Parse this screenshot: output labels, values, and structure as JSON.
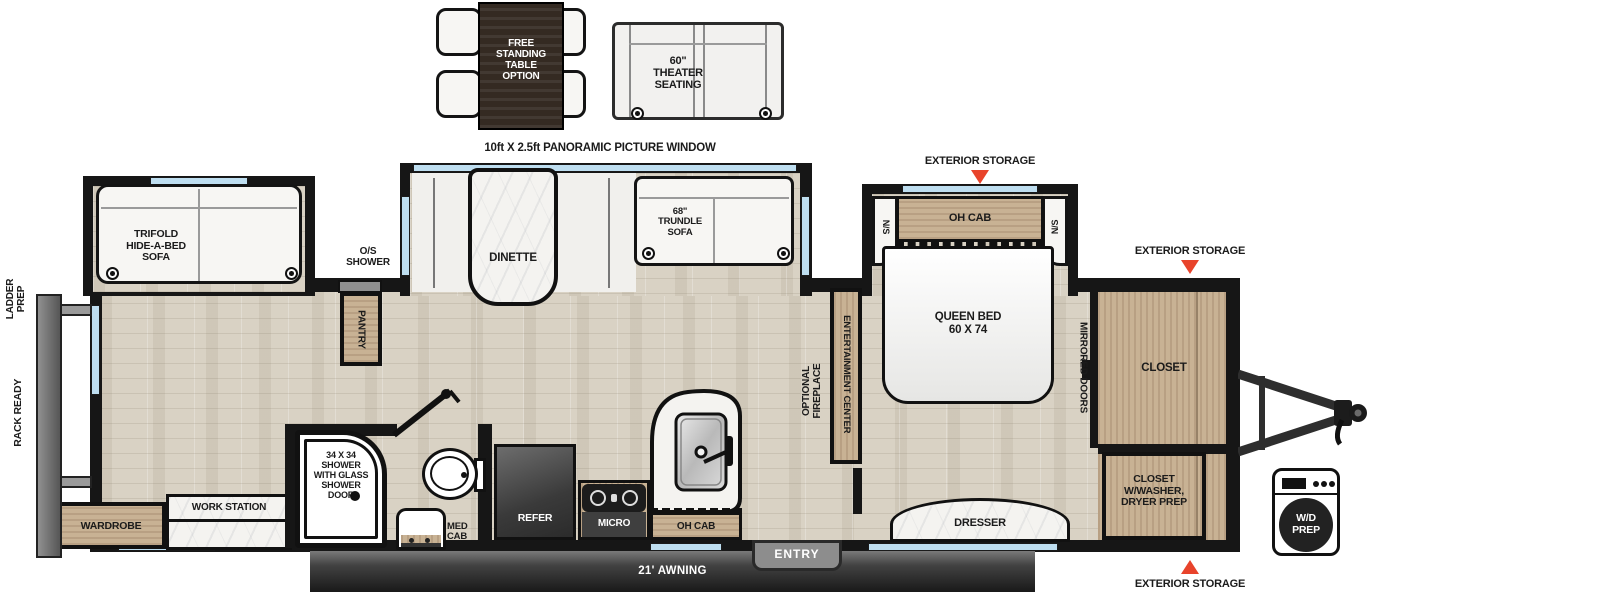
{
  "colors": {
    "accent_red": "#e8432b",
    "window_blue": "#bedef0",
    "wall_black": "#161616",
    "floor_wood": "#d9d2c4",
    "cabinet_wood": "#c8b294"
  },
  "labels": {
    "free_table": "FREE\nSTANDING\nTABLE\nOPTION",
    "theater": "60\"\nTHEATER\nSEATING",
    "panoramic": "10ft X 2.5ft PANORAMIC PICTURE WINDOW",
    "trifold": "TRIFOLD\nHIDE-A-BED\nSOFA",
    "dinette": "DINETTE",
    "trundle": "68\"\nTRUNDLE\nSOFA",
    "os_shower": "O/S\nSHOWER",
    "pantry": "PANTRY",
    "ext_storage_top": "EXTERIOR STORAGE",
    "ext_storage_front": "EXTERIOR STORAGE",
    "ext_storage_bottom": "EXTERIOR STORAGE",
    "oh_cab_bedroom": "OH CAB",
    "ns_left": "N/S",
    "ns_right": "N/S",
    "queen_bed": "QUEEN BED\n60 X 74",
    "mirrored_doors": "MIRRORED DOORS",
    "closet": "CLOSET",
    "entertainment_center": "ENTERTAINMENT CENTER",
    "optional_fireplace": "OPTIONAL\nFIREPLACE",
    "dresser": "DRESSER",
    "closet_washer": "CLOSET\nW/WASHER,\nDRYER PREP",
    "wd_prep": "W/D\nPREP",
    "entry": "ENTRY",
    "awning": "21' AWNING",
    "oh_cab_kitchen": "OH CAB",
    "micro": "MICRO",
    "refer": "REFER",
    "med_cab": "MED\nCAB",
    "shower": "34 X 34\nSHOWER\nWITH GLASS\nSHOWER\nDOOR",
    "work_station": "WORK STATION",
    "wardrobe": "WARDROBE",
    "rack_ready": "RACK READY",
    "ladder_prep": "LADDER\nPREP"
  }
}
